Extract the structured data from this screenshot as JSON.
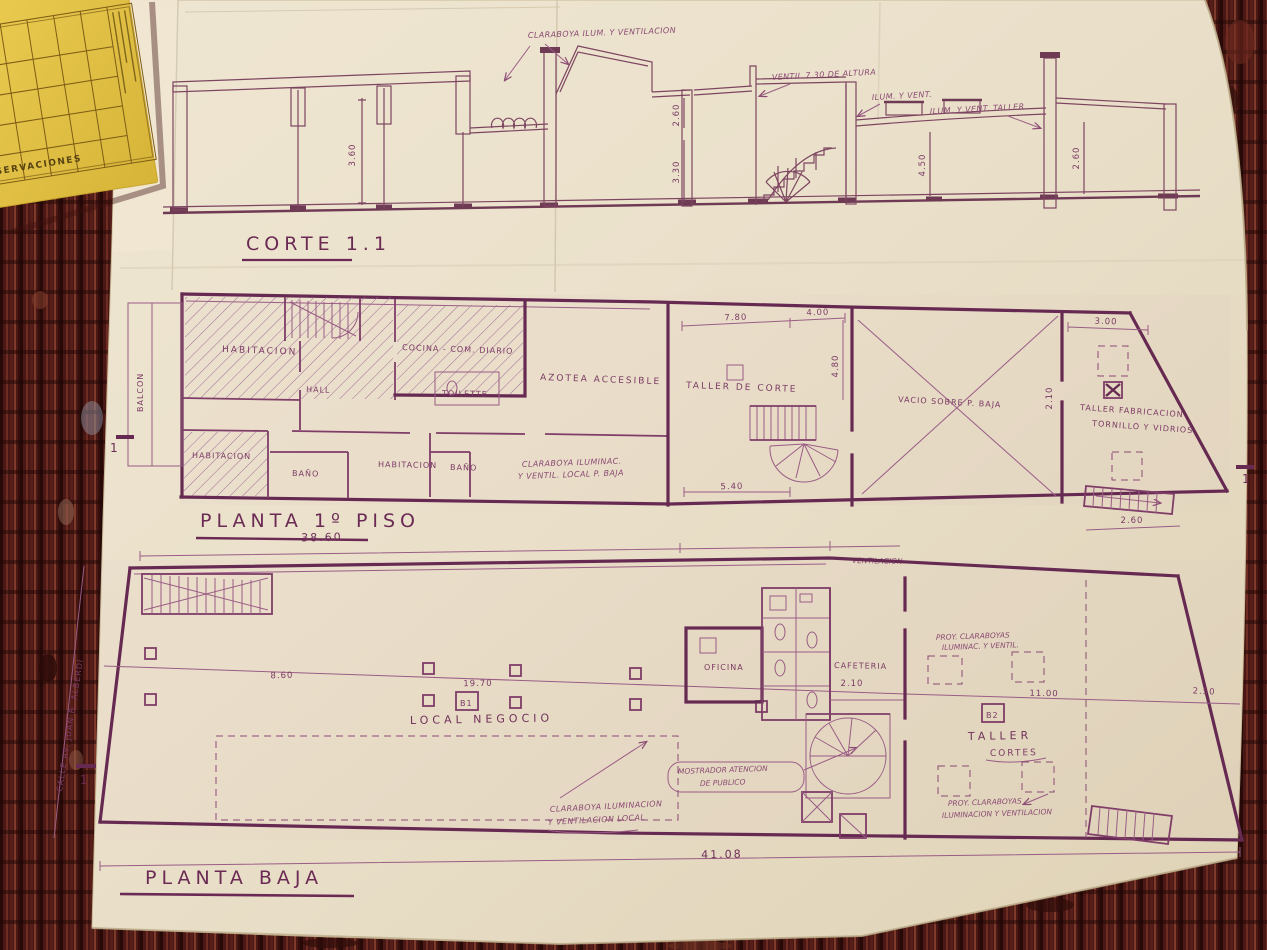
{
  "palette": {
    "paper": "#e9dfc8",
    "ink": "#7b3a64",
    "ink_heavy": "#662a52",
    "ink_section": "#7d4560",
    "carpet": "#4a1814",
    "card": "#e4c344"
  },
  "card": {
    "title": "OBSERVACIONES"
  },
  "corte": {
    "title": "CORTE 1.1",
    "ann_claraboya": "CLARABOYA ILUM. Y VENTILACION",
    "ann_ventil": "VENTIL 7.30 DE ALTURA",
    "ann_ilum": "ILUM. Y VENT.",
    "ann_ilum_taller": "ILUM. Y VENT. TALLER",
    "dim_altura_izq": "3.60",
    "dim_260_sup": "2.60",
    "dim_330": "3.30",
    "dim_450": "4.50",
    "dim_260_der": "2.60"
  },
  "planta1": {
    "title": "PLANTA 1º PISO",
    "rooms": {
      "balcon": "BALCON",
      "hab1": "HABITACION",
      "hall": "HALL",
      "hab2": "HABITACION",
      "bano1": "BAÑO",
      "cocina": "COCINA - COM. DIARIO",
      "toilette": "TOILETTE",
      "hab3": "HABITACION",
      "bano2": "BAÑO",
      "azotea": "AZOTEA ACCESIBLE",
      "claraboya_l1": "CLARABOYA ILUMINAC.",
      "claraboya_l2": "Y VENTIL. LOCAL P. BAJA",
      "taller_corte": "TALLER DE CORTE",
      "vacio": "VACIO SOBRE P. BAJA",
      "taller_fab_l1": "TALLER FABRICACION",
      "taller_fab_l2": "TORNILLO Y VIDRIOS"
    },
    "dims": {
      "d780": "7.80",
      "d400": "4.00",
      "d480": "4.80",
      "d540": "5.40",
      "d300": "3.00",
      "d210": "2.10",
      "d260": "2.60"
    },
    "marker_izq": "1",
    "marker_der": "1"
  },
  "pbaja": {
    "title": "PLANTA BAJA",
    "dim_sup": "38.60",
    "dim_inf": "41.08",
    "nota_vent": "VENTILACION",
    "rooms": {
      "local": "LOCAL NEGOCIO",
      "oficina": "OFICINA",
      "cafeteria": "CAFETERIA",
      "taller": "TALLER",
      "taller_sub": "CORTES",
      "mostrador_l1": "MOSTRADOR ATENCION",
      "mostrador_l2": "DE PUBLICO",
      "claraboya_l1": "CLARABOYA ILUMINACION",
      "claraboya_l2": "Y VENTILACION LOCAL",
      "proy_sup_l1": "PROY. CLARABOYAS",
      "proy_sup_l2": "ILUMINAC. Y VENTIL.",
      "proy_inf_l1": "PROY. CLARABOYAS",
      "proy_inf_l2": "ILUMINACION Y VENTILACION"
    },
    "dims": {
      "d1970": "19.70",
      "d860": "8.60",
      "d1100": "11.00",
      "d250": "2.50",
      "d210": "2.10",
      "d260": "2.60"
    },
    "markers": {
      "b1": "B1",
      "b2": "B2",
      "sec": "1"
    },
    "street": "CALLE AV. JUAN B. ALBERDI"
  }
}
